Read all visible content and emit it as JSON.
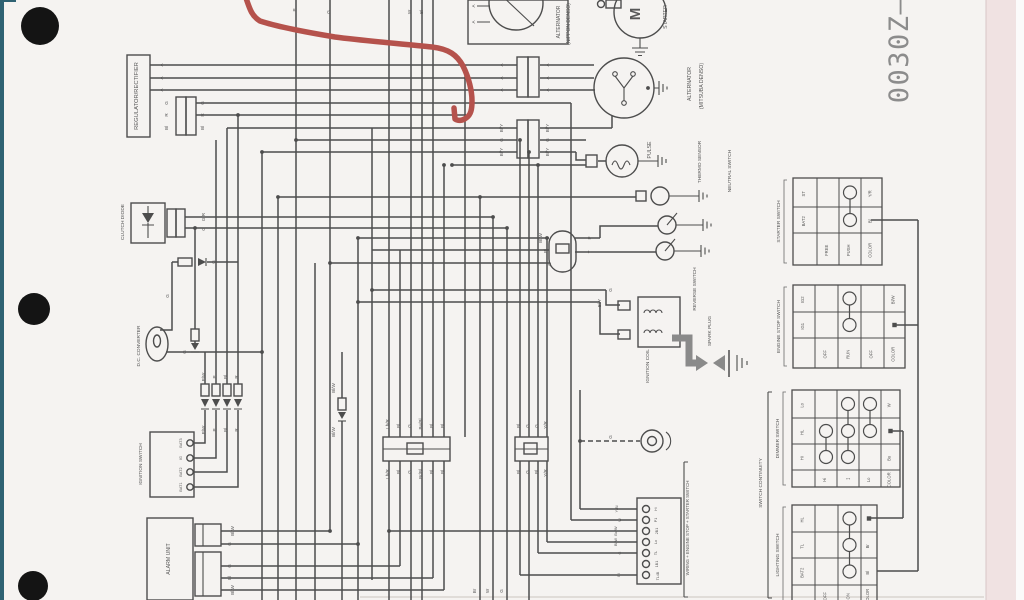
{
  "document": {
    "number": "0030Z—"
  },
  "colors": {
    "background": "#f5f3f1",
    "right_band": "#f0e2e2",
    "edge_strip": "#2f6273",
    "ink": "#4d4d4d",
    "annotation": "#b5524c",
    "thick_arrow": "#8a8a8a",
    "doc_number": "#8c8c8c"
  },
  "component_labels": [
    {
      "t": "REGULATOR/RECTIFIER",
      "x": 138,
      "y": 96,
      "fs": 5.8
    },
    {
      "t": "ALTERNATOR",
      "x": 560,
      "y": 22,
      "fs": 5
    },
    {
      "t": "(NIPPON DENSO)",
      "x": 570,
      "y": 24,
      "fs": 5
    },
    {
      "t": "STARTER",
      "x": 667,
      "y": 17,
      "fs": 5.2
    },
    {
      "t": "M",
      "x": 640,
      "y": 14,
      "fs": 15,
      "b": true
    },
    {
      "t": "ALTERNATOR",
      "x": 691,
      "y": 84,
      "fs": 5.2
    },
    {
      "t": "(MITSUBA DENSO)",
      "x": 703,
      "y": 86,
      "fs": 5.2
    },
    {
      "t": "PULSE",
      "x": 651,
      "y": 150,
      "fs": 5.2
    },
    {
      "t": "THERMO SENSOR",
      "x": 701,
      "y": 162,
      "fs": 4.8
    },
    {
      "t": "NEUTRAL SWITCH",
      "x": 731,
      "y": 171,
      "fs": 4.8
    },
    {
      "t": "REVERSE SWITCH",
      "x": 696,
      "y": 289,
      "fs": 4.8
    },
    {
      "t": "SPARK PLUG",
      "x": 711,
      "y": 331,
      "fs": 4.8
    },
    {
      "t": "IGNITION COIL",
      "x": 649,
      "y": 366,
      "fs": 4.8
    },
    {
      "t": "CLUTCH DIODE",
      "x": 124,
      "y": 222,
      "fs": 4.8
    },
    {
      "t": "D.C. CONVERTER",
      "x": 140,
      "y": 346,
      "fs": 4.8
    },
    {
      "t": "IGNITION SWITCH",
      "x": 142,
      "y": 464,
      "fs": 4.8
    },
    {
      "t": "ALARM UNIT",
      "x": 170,
      "y": 559,
      "fs": 5.2
    },
    {
      "t": "WIRING + ENGINE STOP + STARTER SWITCH",
      "x": 689,
      "y": 528,
      "fs": 4.4
    },
    {
      "t": "SWITCH CONTINUITY",
      "x": 762,
      "y": 483,
      "fs": 4.8
    }
  ],
  "ignition_switch": {
    "terminals": [
      "BAT3",
      "IG",
      "BAT2",
      "BAT1"
    ]
  },
  "harness_connector": {
    "terminals": [
      "Hi",
      "P1",
      "2B1",
      "Lo",
      "TL",
      "1B1",
      "TL4B"
    ]
  },
  "wire_labels": [
    {
      "t": "A",
      "x": 163,
      "y": 65
    },
    {
      "t": "A",
      "x": 163,
      "y": 78
    },
    {
      "t": "A",
      "x": 163,
      "y": 90
    },
    {
      "t": "G",
      "x": 168,
      "y": 103
    },
    {
      "t": "R",
      "x": 168,
      "y": 115
    },
    {
      "t": "Bl",
      "x": 168,
      "y": 128
    },
    {
      "t": "G",
      "x": 204,
      "y": 103
    },
    {
      "t": "R",
      "x": 204,
      "y": 115
    },
    {
      "t": "Bl",
      "x": 204,
      "y": 128
    },
    {
      "t": "P",
      "x": 296,
      "y": 10
    },
    {
      "t": "G",
      "x": 330,
      "y": 12
    },
    {
      "t": "W",
      "x": 411,
      "y": 12
    },
    {
      "t": "Bl",
      "x": 423,
      "y": 12
    },
    {
      "t": "A",
      "x": 475,
      "y": 6
    },
    {
      "t": "A",
      "x": 475,
      "y": 22
    },
    {
      "t": "A",
      "x": 503,
      "y": 65
    },
    {
      "t": "A",
      "x": 503,
      "y": 78
    },
    {
      "t": "A",
      "x": 503,
      "y": 90
    },
    {
      "t": "A",
      "x": 549,
      "y": 65
    },
    {
      "t": "A",
      "x": 549,
      "y": 78
    },
    {
      "t": "A",
      "x": 549,
      "y": 90
    },
    {
      "t": "Bl/Y",
      "x": 503,
      "y": 128
    },
    {
      "t": "G",
      "x": 503,
      "y": 140
    },
    {
      "t": "Bl/Y",
      "x": 503,
      "y": 152
    },
    {
      "t": "Bl/Y",
      "x": 549,
      "y": 128
    },
    {
      "t": "G",
      "x": 549,
      "y": 140
    },
    {
      "t": "Bl/Y",
      "x": 549,
      "y": 152
    },
    {
      "t": "G/R",
      "x": 205,
      "y": 217
    },
    {
      "t": "G",
      "x": 205,
      "y": 229
    },
    {
      "t": "G",
      "x": 215,
      "y": 262
    },
    {
      "t": "G",
      "x": 169,
      "y": 296
    },
    {
      "t": "G",
      "x": 186,
      "y": 352
    },
    {
      "t": "P/W",
      "x": 205,
      "y": 377
    },
    {
      "t": "P",
      "x": 216,
      "y": 377
    },
    {
      "t": "Bl",
      "x": 227,
      "y": 377
    },
    {
      "t": "R",
      "x": 238,
      "y": 377
    },
    {
      "t": "P/W",
      "x": 205,
      "y": 430
    },
    {
      "t": "P",
      "x": 216,
      "y": 430
    },
    {
      "t": "Bl",
      "x": 227,
      "y": 430
    },
    {
      "t": "R",
      "x": 238,
      "y": 430
    },
    {
      "t": "Bl/W",
      "x": 335,
      "y": 388
    },
    {
      "t": "Bl/W",
      "x": 335,
      "y": 432
    },
    {
      "t": "Lb/R",
      "x": 389,
      "y": 424
    },
    {
      "t": "Bl",
      "x": 400,
      "y": 426
    },
    {
      "t": "G",
      "x": 411,
      "y": 426
    },
    {
      "t": "Bu/Bl",
      "x": 422,
      "y": 424
    },
    {
      "t": "Bl",
      "x": 433,
      "y": 426
    },
    {
      "t": "Bl",
      "x": 444,
      "y": 426
    },
    {
      "t": "Lb/R",
      "x": 389,
      "y": 474
    },
    {
      "t": "Bl",
      "x": 400,
      "y": 472
    },
    {
      "t": "G",
      "x": 411,
      "y": 472
    },
    {
      "t": "Br/Bl",
      "x": 422,
      "y": 474
    },
    {
      "t": "Bl",
      "x": 433,
      "y": 472
    },
    {
      "t": "Bl",
      "x": 444,
      "y": 472
    },
    {
      "t": "Bl",
      "x": 520,
      "y": 426
    },
    {
      "t": "G",
      "x": 529,
      "y": 426
    },
    {
      "t": "G",
      "x": 538,
      "y": 426
    },
    {
      "t": "Y/R",
      "x": 547,
      "y": 425
    },
    {
      "t": "Bl",
      "x": 520,
      "y": 472
    },
    {
      "t": "G",
      "x": 529,
      "y": 472
    },
    {
      "t": "Bl",
      "x": 538,
      "y": 472
    },
    {
      "t": "Y/R",
      "x": 547,
      "y": 473
    },
    {
      "t": "Bl/W",
      "x": 542,
      "y": 238
    },
    {
      "t": "Bl",
      "x": 547,
      "y": 251
    },
    {
      "t": "G",
      "x": 551,
      "y": 264
    },
    {
      "t": "P",
      "x": 591,
      "y": 238
    },
    {
      "t": "Y",
      "x": 591,
      "y": 252
    },
    {
      "t": "G",
      "x": 612,
      "y": 290
    },
    {
      "t": "Bl/Y",
      "x": 601,
      "y": 303
    },
    {
      "t": "G",
      "x": 612,
      "y": 437
    },
    {
      "t": "Bl/W",
      "x": 234,
      "y": 531
    },
    {
      "t": "G",
      "x": 231,
      "y": 544
    },
    {
      "t": "G",
      "x": 231,
      "y": 566
    },
    {
      "t": "Bl",
      "x": 231,
      "y": 578
    },
    {
      "t": "Bl/W",
      "x": 234,
      "y": 590
    },
    {
      "t": "Y/Bl",
      "x": 618,
      "y": 509,
      "fs": 3.8
    },
    {
      "t": "W",
      "x": 621,
      "y": 520,
      "fs": 3.8
    },
    {
      "t": "Bu/W",
      "x": 617,
      "y": 531,
      "fs": 3.8
    },
    {
      "t": "Bl/W",
      "x": 617,
      "y": 542,
      "fs": 3.8
    },
    {
      "t": "G",
      "x": 621,
      "y": 553,
      "fs": 3.8
    },
    {
      "t": "Bl",
      "x": 620,
      "y": 575,
      "fs": 3.8
    },
    {
      "t": "Hi",
      "x": 657,
      "y": 509,
      "fs": 3.6
    },
    {
      "t": "P1",
      "x": 657,
      "y": 520,
      "fs": 3.6
    },
    {
      "t": "2B1",
      "x": 658,
      "y": 531,
      "fs": 3.6
    },
    {
      "t": "Lo",
      "x": 657,
      "y": 542,
      "fs": 3.6
    },
    {
      "t": "TL",
      "x": 657,
      "y": 553,
      "fs": 3.6
    },
    {
      "t": "1B1",
      "x": 658,
      "y": 564,
      "fs": 3.6
    },
    {
      "t": "TL4B",
      "x": 659,
      "y": 576,
      "fs": 3.6
    },
    {
      "t": "BAT3",
      "x": 182,
      "y": 443,
      "fs": 3.8
    },
    {
      "t": "IG",
      "x": 182,
      "y": 458,
      "fs": 3.8
    },
    {
      "t": "BAT2",
      "x": 182,
      "y": 472,
      "fs": 3.8
    },
    {
      "t": "BAT1",
      "x": 182,
      "y": 487,
      "fs": 3.8
    },
    {
      "t": "Br",
      "x": 476,
      "y": 591
    },
    {
      "t": "W",
      "x": 489,
      "y": 591
    },
    {
      "t": "G",
      "x": 503,
      "y": 591
    }
  ],
  "tables": [
    {
      "title": "STARTER SWITCH",
      "x": 793,
      "y": 178,
      "cols": [
        24,
        22,
        22,
        21
      ],
      "rows": [
        29,
        26,
        32
      ],
      "cells": [
        [
          "ST",
          "",
          "O",
          "Y/R"
        ],
        [
          "BAT2",
          "",
          "O",
          "Bl"
        ],
        [
          "",
          "FREE",
          "PUSH",
          "COLOR"
        ]
      ],
      "links": [
        {
          "col": 2,
          "from": 0,
          "to": 1
        }
      ]
    },
    {
      "title": "ENGINE STOP SWITCH",
      "x": 793,
      "y": 285,
      "cols": [
        22,
        23,
        23,
        23,
        21
      ],
      "rows": [
        27,
        26,
        30
      ],
      "cells": [
        [
          "IG2",
          "",
          "O",
          "",
          "Bl/W"
        ],
        [
          "IG1",
          "",
          "O",
          "",
          "•"
        ],
        [
          "",
          "OFF",
          "RUN",
          "OFF",
          "COLOR"
        ]
      ],
      "links": [
        {
          "col": 2,
          "from": 0,
          "to": 1
        }
      ]
    },
    {
      "title": "DIMMER SWITCH",
      "x": 792,
      "y": 390,
      "cols": [
        23,
        22,
        22,
        22,
        19
      ],
      "rows": [
        28,
        26,
        26,
        17
      ],
      "cells": [
        [
          "Lo",
          "",
          "O",
          "O",
          "W"
        ],
        [
          "HL",
          "O",
          "O",
          "O",
          "•"
        ],
        [
          "Hi",
          "O",
          "O",
          "",
          "Bu"
        ],
        [
          "",
          "Hi",
          "↔",
          "Lo",
          "COLOR"
        ]
      ],
      "links": [
        {
          "col": 1,
          "from": 1,
          "to": 2
        },
        {
          "col": 2,
          "from": 0,
          "to": 2
        },
        {
          "col": 3,
          "from": 0,
          "to": 1
        }
      ]
    },
    {
      "title": "LIGHTING SWITCH",
      "x": 792,
      "y": 505,
      "cols": [
        23,
        23,
        23,
        16
      ],
      "rows": [
        27,
        26,
        27,
        20
      ],
      "cells": [
        [
          "HL",
          "",
          "O",
          "•"
        ],
        [
          "TL",
          "",
          "O",
          "Br"
        ],
        [
          "BAT2",
          "",
          "O",
          "Bl"
        ],
        [
          "",
          "OFF",
          "ON",
          "COLOR"
        ]
      ],
      "links": [
        {
          "col": 2,
          "from": 0,
          "to": 2
        }
      ]
    }
  ]
}
